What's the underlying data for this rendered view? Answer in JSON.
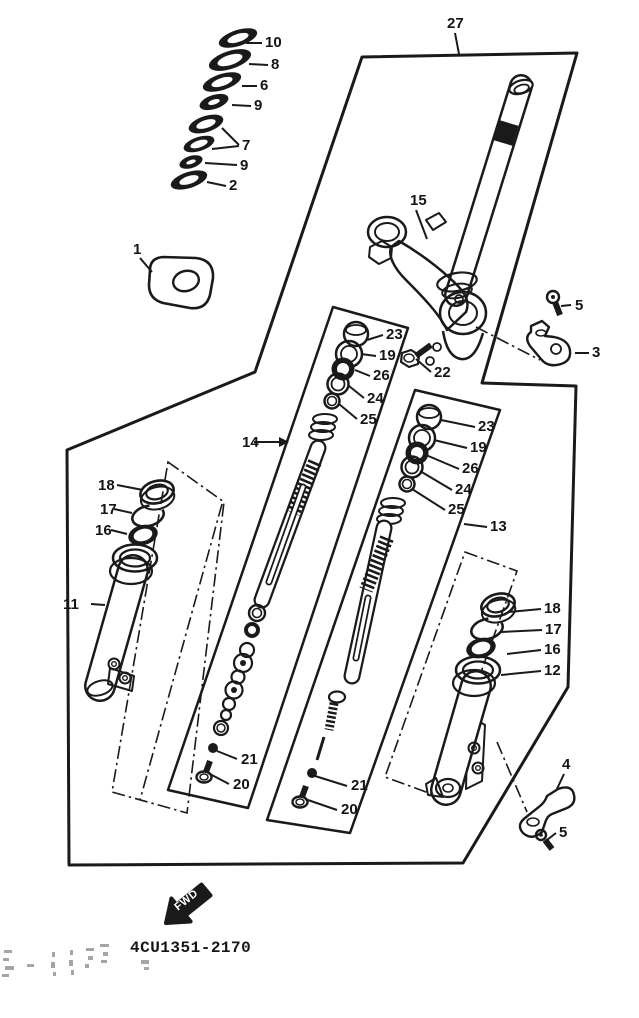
{
  "page": {
    "part_number": "4CU1351-2170",
    "fwd_label": "FWD"
  },
  "callouts": [
    "10",
    "8",
    "6",
    "9",
    "7",
    "9",
    "2",
    "1",
    "27",
    "15",
    "5",
    "3",
    "22",
    "23",
    "19",
    "26",
    "24",
    "25",
    "14",
    "23",
    "19",
    "26",
    "24",
    "25",
    "13",
    "18",
    "17",
    "16",
    "11",
    "18",
    "17",
    "16",
    "12",
    "21",
    "20",
    "21",
    "20",
    "4",
    "5"
  ]
}
